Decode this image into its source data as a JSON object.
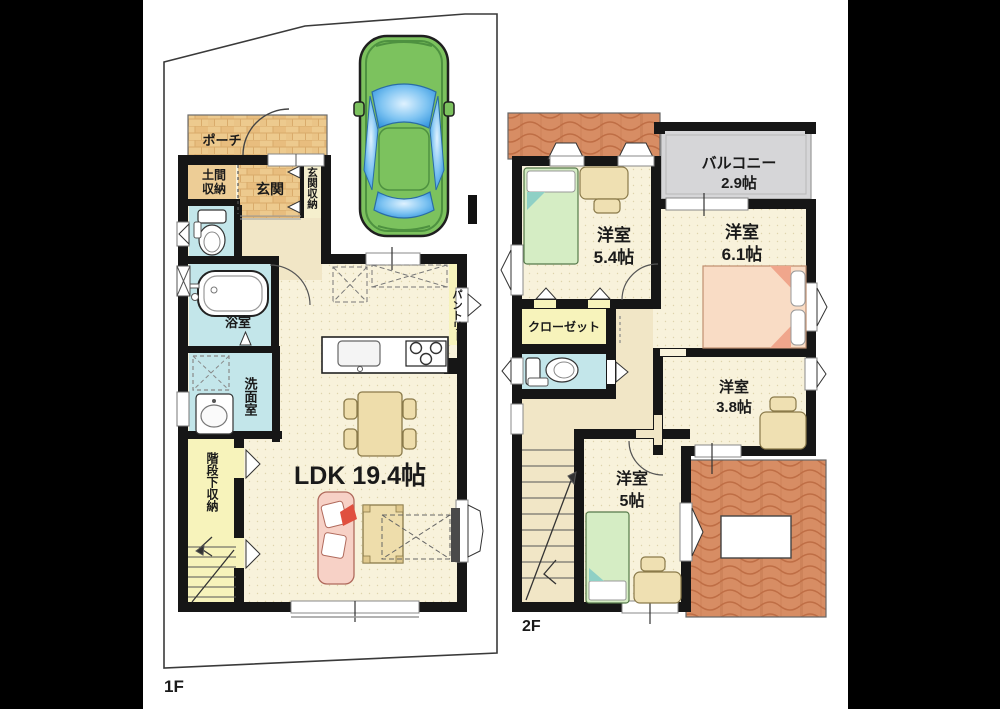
{
  "floor1": {
    "tag": "1F",
    "porch": "ポーチ",
    "doma_l1": "土間",
    "doma_l2": "収納",
    "genkan": "玄関",
    "genkan_storage": "玄関収納",
    "bath": "浴室",
    "washroom": "洗面室",
    "stair_storage": "階段下収納",
    "ldk": "LDK 19.4帖",
    "pantry": "パントリー"
  },
  "floor2": {
    "tag": "2F",
    "balcony_l1": "バルコニー",
    "balcony_l2": "2.9帖",
    "room54_l1": "洋室",
    "room54_l2": "5.4帖",
    "room61_l1": "洋室",
    "room61_l2": "6.1帖",
    "closet": "クローゼット",
    "room38_l1": "洋室",
    "room38_l2": "3.8帖",
    "room5_l1": "洋室",
    "room5_l2": "5帖"
  },
  "colors": {
    "wall": "#161616",
    "floor_cream": "#f8f2db",
    "hall_tan": "#f1e6c6",
    "brick": "#edca8e",
    "water_blue": "#c3e6ea",
    "storage_yellow": "#f7f3bb",
    "balcony_gray": "#d6d6d8",
    "roof_orange": "#d78d64",
    "bed_green": "#d5edc4",
    "bed_pink": "#f9dcc5",
    "sofa_pink": "#f7d1c6",
    "wood_tan": "#eeddab",
    "car_body": "#7cc25e",
    "car_glass": "#4aa7e8",
    "accent_red": "#e0503f"
  }
}
